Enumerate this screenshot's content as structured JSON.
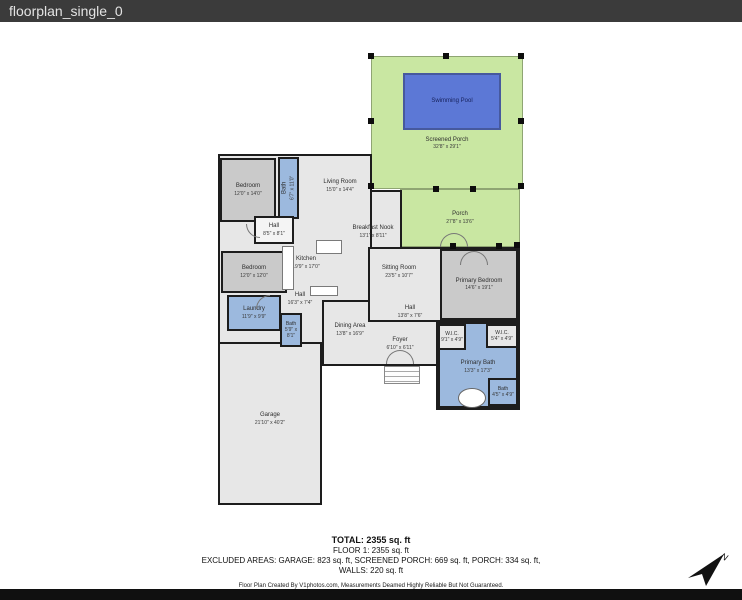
{
  "window": {
    "title": "floorplan_single_0"
  },
  "plan": {
    "rooms": [
      {
        "id": "screened-porch",
        "label": "Screened Porch",
        "dims": "32'8\" x 29'1\""
      },
      {
        "id": "swimming-pool",
        "label": "Swimming Pool",
        "dims": ""
      },
      {
        "id": "porch",
        "label": "Porch",
        "dims": "27'8\" x 13'6\""
      },
      {
        "id": "bedroom-1",
        "label": "Bedroom",
        "dims": "12'0\" x 14'0\""
      },
      {
        "id": "bath-1",
        "label": "Bath",
        "dims": "6'7\" x 11'0\""
      },
      {
        "id": "living-room",
        "label": "Living Room",
        "dims": "15'0\" x 14'4\""
      },
      {
        "id": "hall-1",
        "label": "Hall",
        "dims": "8'5\" x 8'1\""
      },
      {
        "id": "breakfast-nook",
        "label": "Breakfast Nook",
        "dims": "13'1\" x 8'11\""
      },
      {
        "id": "kitchen",
        "label": "Kitchen",
        "dims": "19'9\" x 17'0\""
      },
      {
        "id": "sitting-room",
        "label": "Sitting Room",
        "dims": "23'5\" x 10'7\""
      },
      {
        "id": "bedroom-2",
        "label": "Bedroom",
        "dims": "12'0\" x 12'0\""
      },
      {
        "id": "laundry",
        "label": "Laundry",
        "dims": "11'9\" x 9'9\""
      },
      {
        "id": "hall-2",
        "label": "Hall",
        "dims": "16'3\" x 7'4\""
      },
      {
        "id": "bath-2",
        "label": "Bath",
        "dims": "5'9\" x 8'1\""
      },
      {
        "id": "dining-area",
        "label": "Dining Area",
        "dims": "13'8\" x 16'9\""
      },
      {
        "id": "hall-3",
        "label": "Hall",
        "dims": "13'8\" x 7'6\""
      },
      {
        "id": "foyer",
        "label": "Foyer",
        "dims": "6'10\" x 6'11\""
      },
      {
        "id": "primary-bedroom",
        "label": "Primary Bedroom",
        "dims": "14'6\" x 19'1\""
      },
      {
        "id": "wic-1",
        "label": "W.I.C.",
        "dims": "9'1\" x 4'9\""
      },
      {
        "id": "wic-2",
        "label": "W.I.C.",
        "dims": "5'4\" x 4'9\""
      },
      {
        "id": "primary-bath",
        "label": "Primary Bath",
        "dims": "13'3\" x 17'3\""
      },
      {
        "id": "bath-3",
        "label": "Bath",
        "dims": "4'5\" x 4'9\""
      },
      {
        "id": "garage",
        "label": "Garage",
        "dims": "21'10\" x 40'2\""
      }
    ]
  },
  "summary": {
    "total": "TOTAL: 2355 sq. ft",
    "floor1": "FLOOR 1: 2355 sq. ft",
    "excluded": "EXCLUDED AREAS: GARAGE: 823 sq. ft, SCREENED PORCH: 669 sq. ft, PORCH: 334 sq. ft,",
    "walls": "WALLS: 220 sq. ft",
    "credit": "Floor Plan Created By V1photos.com, Measurements Deamed Highly Reliable But Not Guaranteed."
  },
  "compass": {
    "label": "N"
  },
  "colors": {
    "pool": "#5c78d6",
    "wet_room_blue": "#9cb9de",
    "porch_green": "#c9e7a2",
    "bedroom_gray": "#cacaca",
    "open_gray": "#e7e7e7",
    "wall": "#1d1d1d",
    "titlebar_bg": "#3b3b3b"
  }
}
